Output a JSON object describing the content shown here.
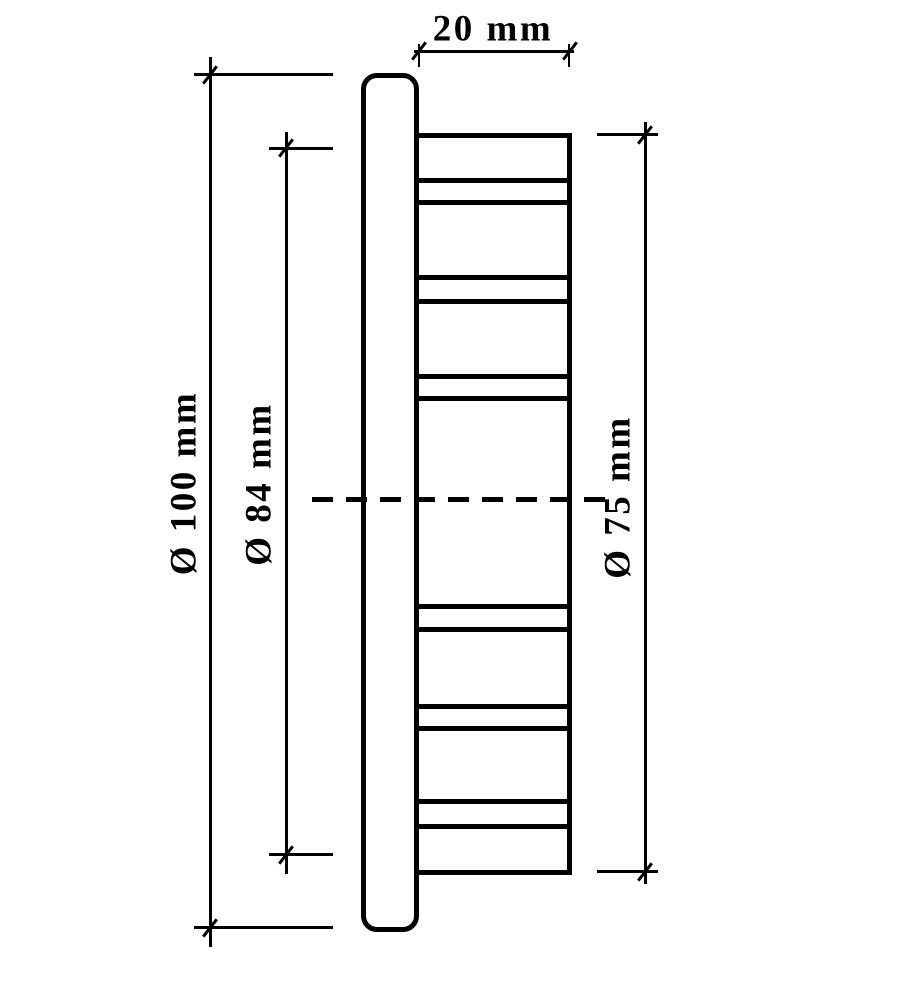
{
  "drawing": {
    "background_color": "#ffffff",
    "line_color": "#000000",
    "rib_band_count": 6,
    "labels": {
      "body_width": "20 mm",
      "flange_diameter": "Ø 100 mm",
      "intermediate_diameter": "Ø 84 mm",
      "body_diameter": "Ø 75 mm"
    },
    "values": {
      "body_width_mm": 20,
      "flange_diameter_mm": 100,
      "intermediate_diameter_mm": 84,
      "body_diameter_mm": 75
    }
  }
}
